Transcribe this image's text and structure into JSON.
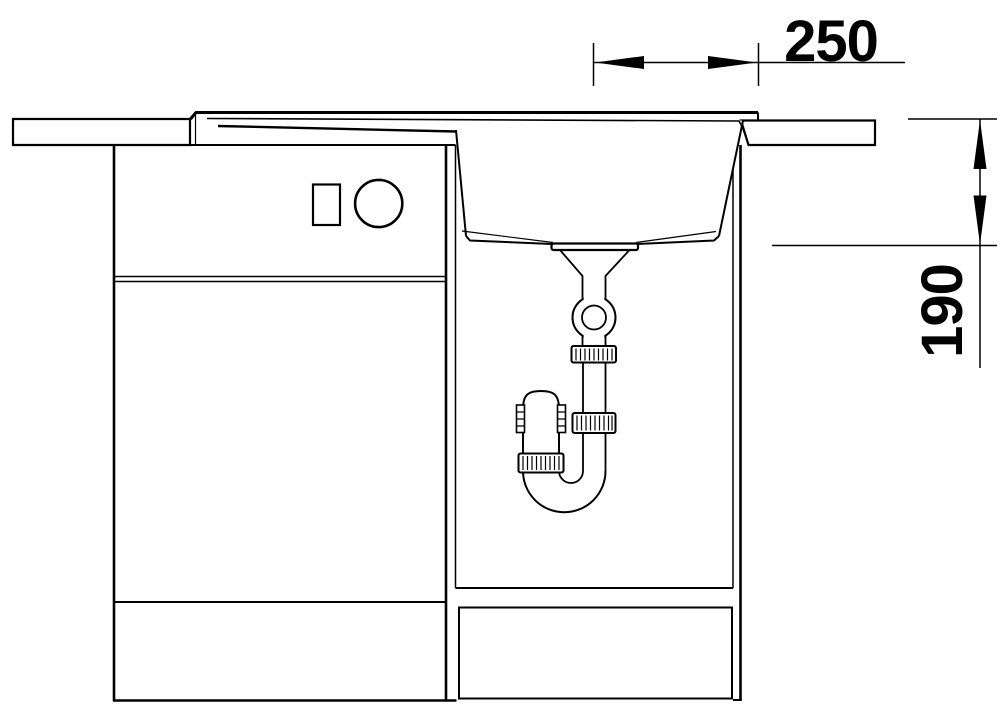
{
  "drawing": {
    "kind": "technical-section-drawing",
    "subject": "kitchen-sink-with-cabinet-and-drain-trap",
    "line_color": "#000000",
    "background_color": "#ffffff",
    "dimensions": {
      "horizontal": "250",
      "vertical": "190"
    }
  }
}
